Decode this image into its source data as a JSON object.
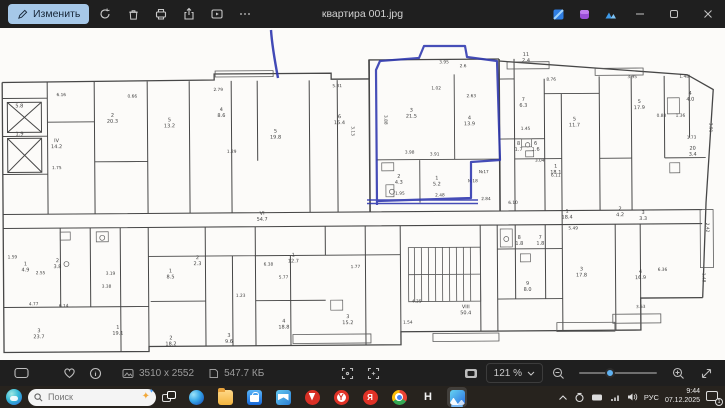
{
  "titlebar": {
    "edit_label": "Изменить",
    "filename": "квартира 001.jpg"
  },
  "statusbar": {
    "dimensions": "3510 x 2552",
    "filesize": "547.7 КБ",
    "zoom": "121 %"
  },
  "taskbar": {
    "search_placeholder": "Поиск",
    "language": "РУС",
    "time": "9:44",
    "date": "07.12.2025",
    "notification_count": "1",
    "app_h_label": "H",
    "yandex_browser_letter": "Y",
    "yandex_letter": "Я"
  },
  "colors": {
    "pen_blue": "#2c35ae",
    "accent_blue": "#5fb2f2",
    "edit_button_bg": "#a6c8e8"
  },
  "floorplan": {
    "rooms": [
      {
        "x": 20,
        "y": 99,
        "n": "",
        "a": "5.8"
      },
      {
        "x": 20,
        "y": 127,
        "n": "",
        "a": "1.9"
      },
      {
        "x": 57,
        "y": 140,
        "n": "IV",
        "a": "14.2"
      },
      {
        "x": 113,
        "y": 115,
        "n": "2",
        "a": "20.3"
      },
      {
        "x": 170,
        "y": 120,
        "n": "5",
        "a": "13.2"
      },
      {
        "x": 222,
        "y": 110,
        "n": "4",
        "a": "8.6"
      },
      {
        "x": 276,
        "y": 132,
        "n": "5",
        "a": "19.8"
      },
      {
        "x": 340,
        "y": 118,
        "n": "6",
        "a": "15.4"
      },
      {
        "x": 412,
        "y": 112,
        "n": "3",
        "a": "21.5"
      },
      {
        "x": 470,
        "y": 120,
        "n": "4",
        "a": "13.9"
      },
      {
        "x": 399,
        "y": 178,
        "n": "2",
        "a": "4.3"
      },
      {
        "x": 437,
        "y": 180,
        "n": "1",
        "a": "5.2"
      },
      {
        "x": 527,
        "y": 57,
        "n": "11",
        "a": "2.4"
      },
      {
        "x": 524,
        "y": 102,
        "n": "7",
        "a": "6.3"
      },
      {
        "x": 519,
        "y": 146,
        "n": "8",
        "a": "1.7"
      },
      {
        "x": 536,
        "y": 146,
        "n": "6",
        "a": "1.6"
      },
      {
        "x": 556,
        "y": 169,
        "n": "1",
        "a": "18.1"
      },
      {
        "x": 575,
        "y": 122,
        "n": "5",
        "a": "11.7"
      },
      {
        "x": 640,
        "y": 105,
        "n": "5",
        "a": "17.9"
      },
      {
        "x": 691,
        "y": 97,
        "n": "4",
        "a": "4.0"
      },
      {
        "x": 693,
        "y": 152,
        "n": "20",
        "a": "3.4"
      },
      {
        "x": 25,
        "y": 263,
        "n": "1",
        "a": "4.9"
      },
      {
        "x": 57,
        "y": 260,
        "n": "2",
        "a": "3.8"
      },
      {
        "x": 38,
        "y": 330,
        "n": "3",
        "a": "23.7"
      },
      {
        "x": 117,
        "y": 327,
        "n": "1",
        "a": "19.1"
      },
      {
        "x": 170,
        "y": 271,
        "n": "1",
        "a": "8.5"
      },
      {
        "x": 197,
        "y": 258,
        "n": "2",
        "a": "2.3"
      },
      {
        "x": 262,
        "y": 214,
        "n": "VI",
        "a": "54.7"
      },
      {
        "x": 293,
        "y": 256,
        "n": "1",
        "a": "12.7"
      },
      {
        "x": 283,
        "y": 322,
        "n": "4",
        "a": "18.8"
      },
      {
        "x": 228,
        "y": 336,
        "n": "3",
        "a": "9.6"
      },
      {
        "x": 170,
        "y": 338,
        "n": "2",
        "a": "18.2"
      },
      {
        "x": 347,
        "y": 318,
        "n": "3",
        "a": "15.2"
      },
      {
        "x": 465,
        "y": 309,
        "n": "VIII",
        "a": "50.4"
      },
      {
        "x": 567,
        "y": 214,
        "n": "1",
        "a": "18.4"
      },
      {
        "x": 519,
        "y": 240,
        "n": "8",
        "a": "1.8"
      },
      {
        "x": 540,
        "y": 240,
        "n": "7",
        "a": "1.8"
      },
      {
        "x": 527,
        "y": 286,
        "n": "9",
        "a": "8.0"
      },
      {
        "x": 581,
        "y": 272,
        "n": "3",
        "a": "17.8"
      },
      {
        "x": 640,
        "y": 275,
        "n": "4",
        "a": "16.9"
      },
      {
        "x": 620,
        "y": 212,
        "n": "2",
        "a": "4.2"
      },
      {
        "x": 643,
        "y": 216,
        "n": "3",
        "a": "3.3"
      }
    ],
    "dims": [
      {
        "x": 62,
        "y": 94,
        "t": "6.16"
      },
      {
        "x": 133,
        "y": 96,
        "t": "0.66"
      },
      {
        "x": 219,
        "y": 90,
        "t": "2.79"
      },
      {
        "x": 338,
        "y": 87,
        "t": "5.31"
      },
      {
        "x": 352,
        "y": 131,
        "t": "3.13",
        "r": 90
      },
      {
        "x": 232,
        "y": 152,
        "t": "1.29"
      },
      {
        "x": 57,
        "y": 167,
        "t": "1.75"
      },
      {
        "x": 445,
        "y": 64,
        "t": "3.95"
      },
      {
        "x": 464,
        "y": 68,
        "t": "2.6"
      },
      {
        "x": 437,
        "y": 90,
        "t": "1.02"
      },
      {
        "x": 472,
        "y": 98,
        "t": "2.63"
      },
      {
        "x": 385,
        "y": 120,
        "t": "3.88",
        "r": 90
      },
      {
        "x": 410,
        "y": 154,
        "t": "3.98"
      },
      {
        "x": 435,
        "y": 156,
        "t": "3.91"
      },
      {
        "x": 400,
        "y": 195,
        "t": "1.95"
      },
      {
        "x": 440,
        "y": 197,
        "t": "2.48"
      },
      {
        "x": 486,
        "y": 201,
        "t": "2.84"
      },
      {
        "x": 484,
        "y": 174,
        "t": "№17"
      },
      {
        "x": 473,
        "y": 183,
        "t": "№18"
      },
      {
        "x": 513,
        "y": 205,
        "t": "6.10"
      },
      {
        "x": 552,
        "y": 82,
        "t": "8.76"
      },
      {
        "x": 633,
        "y": 80,
        "t": "3.95"
      },
      {
        "x": 685,
        "y": 80,
        "t": "1.48"
      },
      {
        "x": 662,
        "y": 119,
        "t": "0.88"
      },
      {
        "x": 681,
        "y": 119,
        "t": "1.36"
      },
      {
        "x": 692,
        "y": 141,
        "t": "1.73"
      },
      {
        "x": 526,
        "y": 131,
        "t": "1.45"
      },
      {
        "x": 540,
        "y": 163,
        "t": "3.04"
      },
      {
        "x": 556,
        "y": 178,
        "t": "6.11"
      },
      {
        "x": 12,
        "y": 256,
        "t": "1.59"
      },
      {
        "x": 40,
        "y": 272,
        "t": "2.55"
      },
      {
        "x": 110,
        "y": 273,
        "t": "3.19"
      },
      {
        "x": 106,
        "y": 286,
        "t": "3.38"
      },
      {
        "x": 33,
        "y": 303,
        "t": "4.77"
      },
      {
        "x": 63,
        "y": 305,
        "t": "6.14"
      },
      {
        "x": 268,
        "y": 265,
        "t": "6.38"
      },
      {
        "x": 283,
        "y": 278,
        "t": "5.77"
      },
      {
        "x": 240,
        "y": 296,
        "t": "1.23"
      },
      {
        "x": 355,
        "y": 268,
        "t": "1.77"
      },
      {
        "x": 416,
        "y": 303,
        "t": "4.35"
      },
      {
        "x": 407,
        "y": 324,
        "t": "1.54"
      },
      {
        "x": 573,
        "y": 231,
        "t": "5.49"
      },
      {
        "x": 662,
        "y": 273,
        "t": "6.36"
      },
      {
        "x": 640,
        "y": 310,
        "t": "3.53"
      },
      {
        "x": 710,
        "y": 130,
        "t": "3.91",
        "r": 90
      },
      {
        "x": 706,
        "y": 230,
        "t": "2.42",
        "r": 90
      },
      {
        "x": 702,
        "y": 280,
        "t": "1.48",
        "r": 90
      }
    ]
  }
}
